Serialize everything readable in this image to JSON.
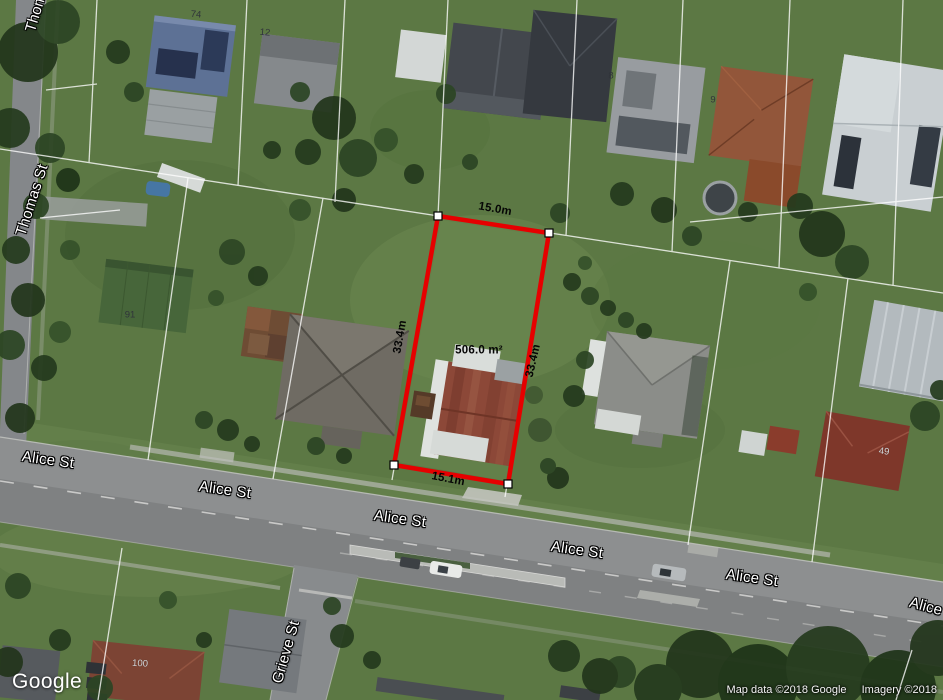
{
  "map": {
    "provider_logo": "Google",
    "streets": {
      "thomas": "Thomas St",
      "alice": "Alice St",
      "grieve": "Grieve St"
    },
    "measurements": {
      "top_edge": "15.0m",
      "bottom_edge": "15.1m",
      "left_side": "33.4m",
      "right_side": "33.4m",
      "area": "506.0 m²"
    },
    "house_numbers": {
      "n74": "74",
      "n12": "12",
      "n8": "8",
      "n9": "9",
      "n91": "91",
      "n49": "49",
      "n100": "100"
    },
    "attribution": {
      "map_data": "Map data ©2018 Google",
      "imagery": "Imagery ©2018"
    },
    "colors": {
      "boundary_red": "#e60000",
      "cadastral_white": "#ffffff",
      "road_gray": "#8d8f90",
      "grass_green": "#5c7844"
    }
  }
}
